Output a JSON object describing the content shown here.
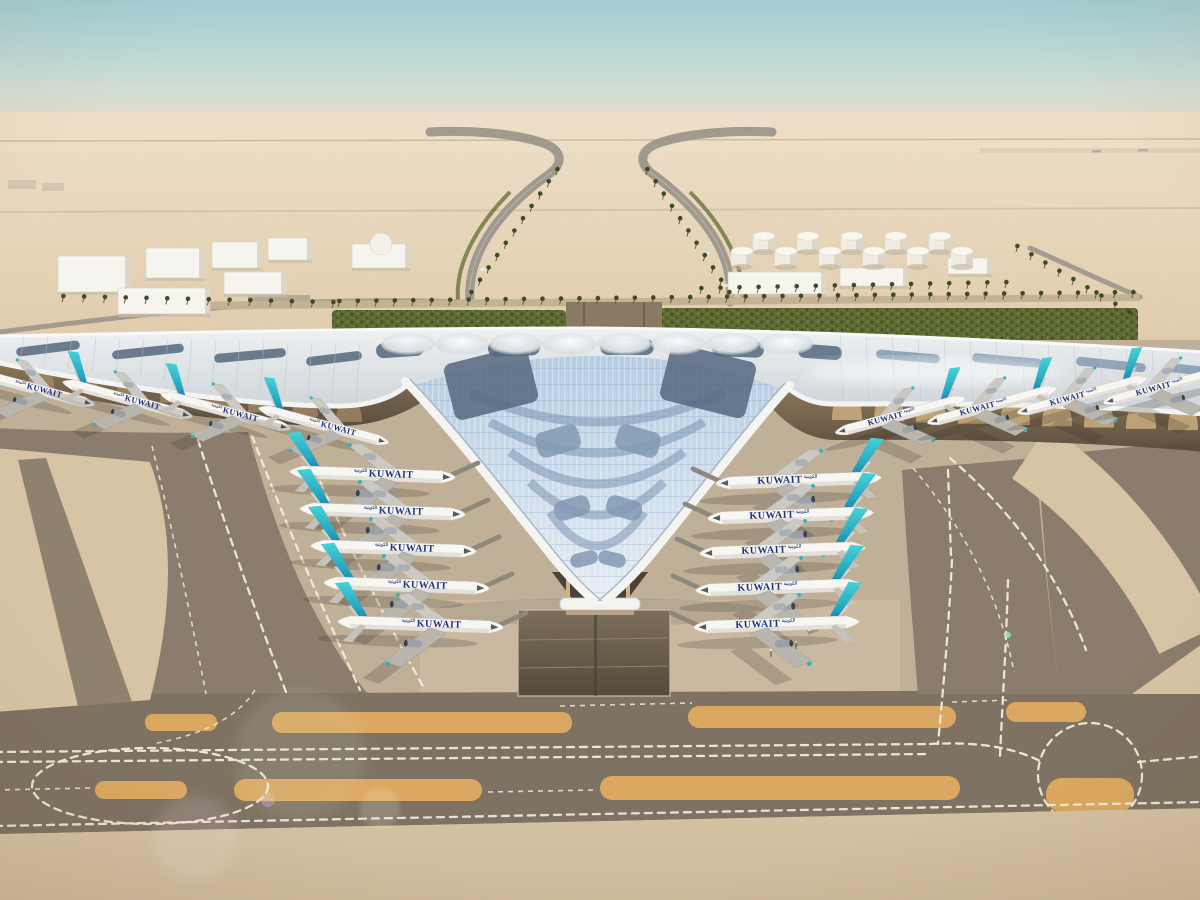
{
  "meta": {
    "description": "Aerial 3D architectural rendering of Kuwait International Airport new terminal: white trefoil roof with photovoltaic fern pattern, Kuwait Airways aircraft parked at gates, desert taxiways and runways",
    "setting": "desert airport, hazy horizon"
  },
  "livery": {
    "airline_title": "KUWAIT",
    "arabic_title": "الكويتية"
  },
  "palette": {
    "apron": "#c1b098",
    "apron_light": "#cab9a0",
    "asphalt": "#8a7d6d",
    "asphalt_dark": "#7e7263",
    "sand_island": "#d6c4a5",
    "orange_strip": "#dca861",
    "marking": "#f2ebd9",
    "road": "#9c968c",
    "green_band": "#5d6a33",
    "roof_silver": "#e9ecee",
    "panel_blue": "#bdd2e6",
    "solar_dark": "#55677e",
    "solar_mid": "#8299b1",
    "eave_shadow": "#6b5c48",
    "arch_tan": "#c8a97c",
    "navy": "#1d3280",
    "tail_teal": "#3fc9cd",
    "tail_blue": "#1565a8",
    "fuselage_white": "#f7f6f2",
    "building_white": "#f6f4ee",
    "sky_top": "#a3ced3",
    "haze_sand": "#ead9c0"
  },
  "aircraft_groups": [
    {
      "name": "pier-left",
      "rot": 15,
      "dir": 1,
      "scale": 0.78,
      "bridge": false,
      "positions": [
        [
          -28,
          372
        ],
        [
          70,
          384
        ],
        [
          168,
          396
        ],
        [
          266,
          410
        ]
      ]
    },
    {
      "name": "pier-right",
      "rot": -15,
      "dir": -1,
      "scale": 0.78,
      "bridge": false,
      "positions": [
        [
          958,
          400
        ],
        [
          1050,
          390
        ],
        [
          1140,
          380
        ],
        [
          1226,
          370
        ]
      ]
    },
    {
      "name": "column-left",
      "rot": 2,
      "dir": 1,
      "scale": 0.96,
      "bridge": true,
      "positions": [
        [
          299,
          472
        ],
        [
          309,
          509
        ],
        [
          320,
          546
        ],
        [
          333,
          583
        ],
        [
          347,
          622
        ]
      ]
    },
    {
      "name": "column-right",
      "rot": -2,
      "dir": -1,
      "scale": 0.96,
      "bridge": true,
      "positions": [
        [
          872,
          478
        ],
        [
          864,
          513
        ],
        [
          856,
          548
        ],
        [
          852,
          585
        ],
        [
          850,
          622
        ]
      ]
    }
  ],
  "tanks": {
    "front_row": {
      "y": 266,
      "xs": [
        742,
        786,
        830,
        874,
        918,
        962
      ]
    },
    "back_row": {
      "y": 251,
      "xs": [
        764,
        808,
        852,
        896,
        940
      ]
    },
    "radius": 11,
    "height": 15
  },
  "buildings": {
    "white_blocks": [
      [
        58,
        256,
        72,
        36
      ],
      [
        146,
        248,
        58,
        30
      ],
      [
        212,
        242,
        50,
        26
      ],
      [
        268,
        238,
        44,
        22
      ],
      [
        118,
        288,
        92,
        26
      ],
      [
        224,
        272,
        62,
        22
      ],
      [
        352,
        244,
        58,
        24
      ],
      [
        728,
        272,
        98,
        22
      ],
      [
        840,
        268,
        68,
        18
      ],
      [
        948,
        258,
        44,
        16
      ]
    ],
    "dome": {
      "cx": 381,
      "cy": 244,
      "r": 11
    },
    "distant_gray": [
      [
        8,
        180,
        28,
        9
      ],
      [
        42,
        183,
        22,
        8
      ]
    ]
  },
  "palm_rows": [
    {
      "x1": 338,
      "y1": 307,
      "x2": 1132,
      "y2": 298,
      "n": 44
    },
    {
      "x1": 62,
      "y1": 302,
      "x2": 332,
      "y2": 308,
      "n": 14
    },
    {
      "x1": 470,
      "y1": 298,
      "x2": 556,
      "y2": 175,
      "n": 11
    },
    {
      "x1": 728,
      "y1": 298,
      "x2": 646,
      "y2": 175,
      "n": 11
    },
    {
      "x1": 1016,
      "y1": 252,
      "x2": 1128,
      "y2": 318,
      "n": 9
    },
    {
      "x1": 700,
      "y1": 294,
      "x2": 1005,
      "y2": 288,
      "n": 17
    }
  ],
  "arches": {
    "right": {
      "x0": 832,
      "dx": 42,
      "y0": 394,
      "slope": 0.03,
      "w": 30,
      "h": 26,
      "n": 9
    },
    "left": {
      "x0": 28,
      "dx": 44,
      "y0": 368,
      "slope": 0.11,
      "w": 26,
      "h": 20,
      "n": 8
    }
  },
  "solar_patches": [
    [
      376,
      342,
      48,
      15,
      -4,
      "d"
    ],
    [
      488,
      340,
      52,
      16,
      -2,
      "d"
    ],
    [
      600,
      339,
      54,
      16,
      0,
      "d"
    ],
    [
      712,
      341,
      52,
      16,
      2,
      "d"
    ],
    [
      798,
      345,
      44,
      14,
      4,
      "d"
    ],
    [
      16,
      344,
      64,
      9,
      -7,
      "d"
    ],
    [
      112,
      347,
      72,
      9,
      -6,
      "d"
    ],
    [
      214,
      351,
      72,
      9,
      -5,
      "d"
    ],
    [
      306,
      354,
      56,
      9,
      -7,
      "d"
    ],
    [
      876,
      352,
      64,
      9,
      5,
      "m"
    ],
    [
      972,
      356,
      70,
      9,
      5,
      "m"
    ],
    [
      1076,
      360,
      70,
      9,
      6,
      "m"
    ],
    [
      1168,
      365,
      40,
      9,
      6,
      "m"
    ],
    [
      448,
      354,
      86,
      58,
      -14,
      "d"
    ],
    [
      664,
      352,
      88,
      58,
      14,
      "d"
    ],
    [
      536,
      428,
      44,
      26,
      -16,
      "m"
    ],
    [
      616,
      428,
      44,
      26,
      16,
      "m"
    ],
    [
      554,
      498,
      36,
      20,
      -16,
      "m"
    ],
    [
      606,
      498,
      36,
      20,
      16,
      "m"
    ],
    [
      570,
      552,
      28,
      14,
      -14,
      "m"
    ],
    [
      598,
      552,
      28,
      14,
      14,
      "m"
    ]
  ],
  "vehicles": {
    "truck": {
      "x": 812,
      "y": 627,
      "rot": -20
    },
    "distant_cars": [
      [
        480,
        268
      ],
      [
        704,
        252
      ],
      [
        722,
        284
      ]
    ],
    "posts": [
      [
        795,
        649
      ],
      [
        770,
        657
      ]
    ]
  }
}
